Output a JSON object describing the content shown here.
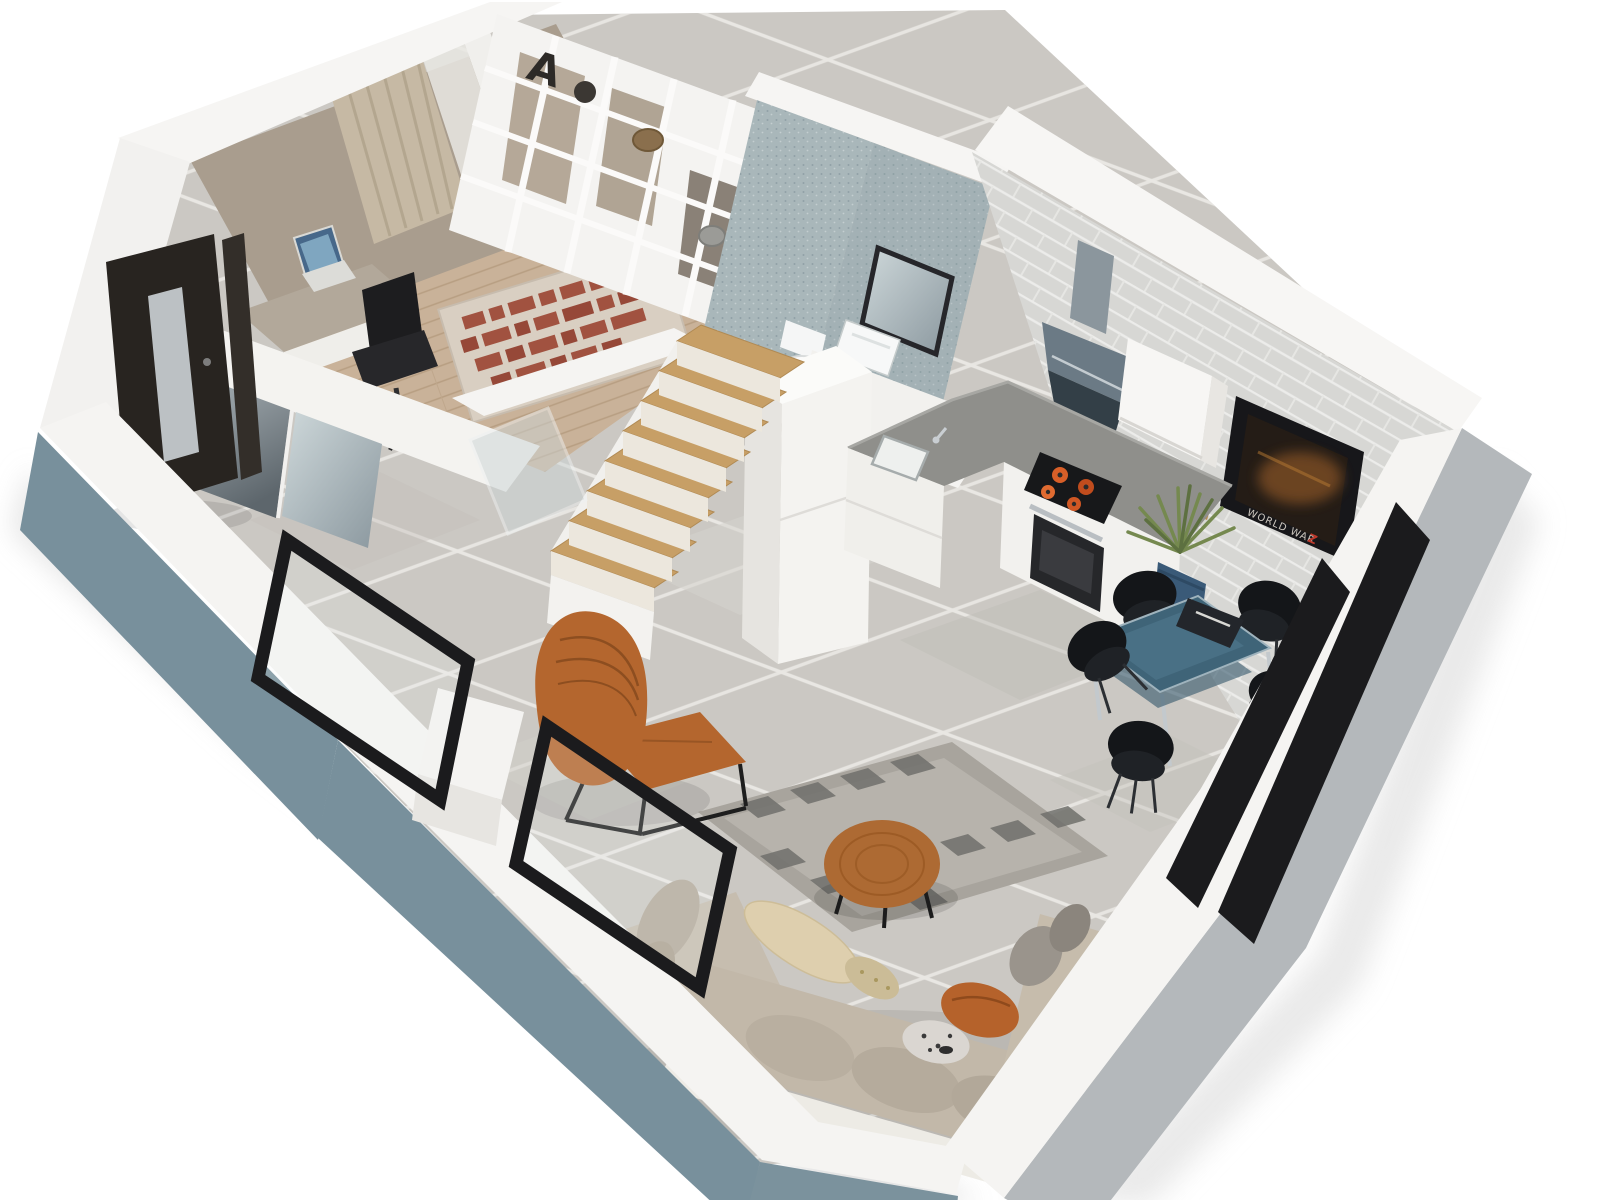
{
  "meta": {
    "type": "3d-floor-plan-render",
    "view": "isometric-cutaway",
    "description": "3D rendered floor plan of a small apartment with bedroom-office, bathroom, kitchen, dining area, living room, entry hall and interior stairs"
  },
  "text": {
    "shelf_letter": "A",
    "tv_poster": "WORLD WAR",
    "tv_poster_accent": "Z"
  },
  "palette": {
    "wall_white": "#f5f4f2",
    "wall_taupe": "#a99d8e",
    "base_blue": "#78909c",
    "right_wall_gray": "#b4b8bb",
    "brick_wall": "#d7d7d4",
    "bath_wall": "#a9b7ba",
    "tile_floor": "#cbc8c3",
    "wood_floor": "#c9b299",
    "stair_wood": "#c79f66",
    "counter_gray": "#8f8f8b",
    "backsplash_wood": "#b5894f",
    "accent_orange": "#b4662e",
    "table_blue": "#3f6478",
    "sofa_beige": "#c2b8a9",
    "frame_black": "#1b1b1d",
    "rug_letters": "#9c4532"
  },
  "rooms": [
    {
      "name": "bedroom-office",
      "furniture": [
        "shelving-unit",
        "letter-a-decor",
        "desk",
        "laptop",
        "office-chair",
        "typography-rug",
        "curtained-window",
        "mirrored-wardrobe-partition"
      ]
    },
    {
      "name": "bathroom",
      "furniture": [
        "wall-hung-toilet",
        "washbasin",
        "mirror"
      ]
    },
    {
      "name": "kitchen",
      "furniture": [
        "l-shaped-cabinets",
        "sink",
        "gas-cooktop",
        "oven",
        "range-hood",
        "upper-cabinet",
        "tall-cabinet",
        "wood-backsplash",
        "plant-pot"
      ]
    },
    {
      "name": "dining-area",
      "furniture": [
        "glass-dining-table",
        "dining-chairs"
      ],
      "dining_chair_count": 5
    },
    {
      "name": "living-room",
      "furniture": [
        "corner-sofa",
        "pillows",
        "round-coffee-table",
        "checkered-rug",
        "lounge-chair",
        "ottoman",
        "wall-tv"
      ]
    },
    {
      "name": "entry-hall",
      "furniture": [
        "entrance-door",
        "mirrored-wardrobe",
        "glass-partition"
      ]
    },
    {
      "name": "stairs",
      "furniture": [
        "wooden-treads"
      ],
      "tread_count": 8
    }
  ]
}
